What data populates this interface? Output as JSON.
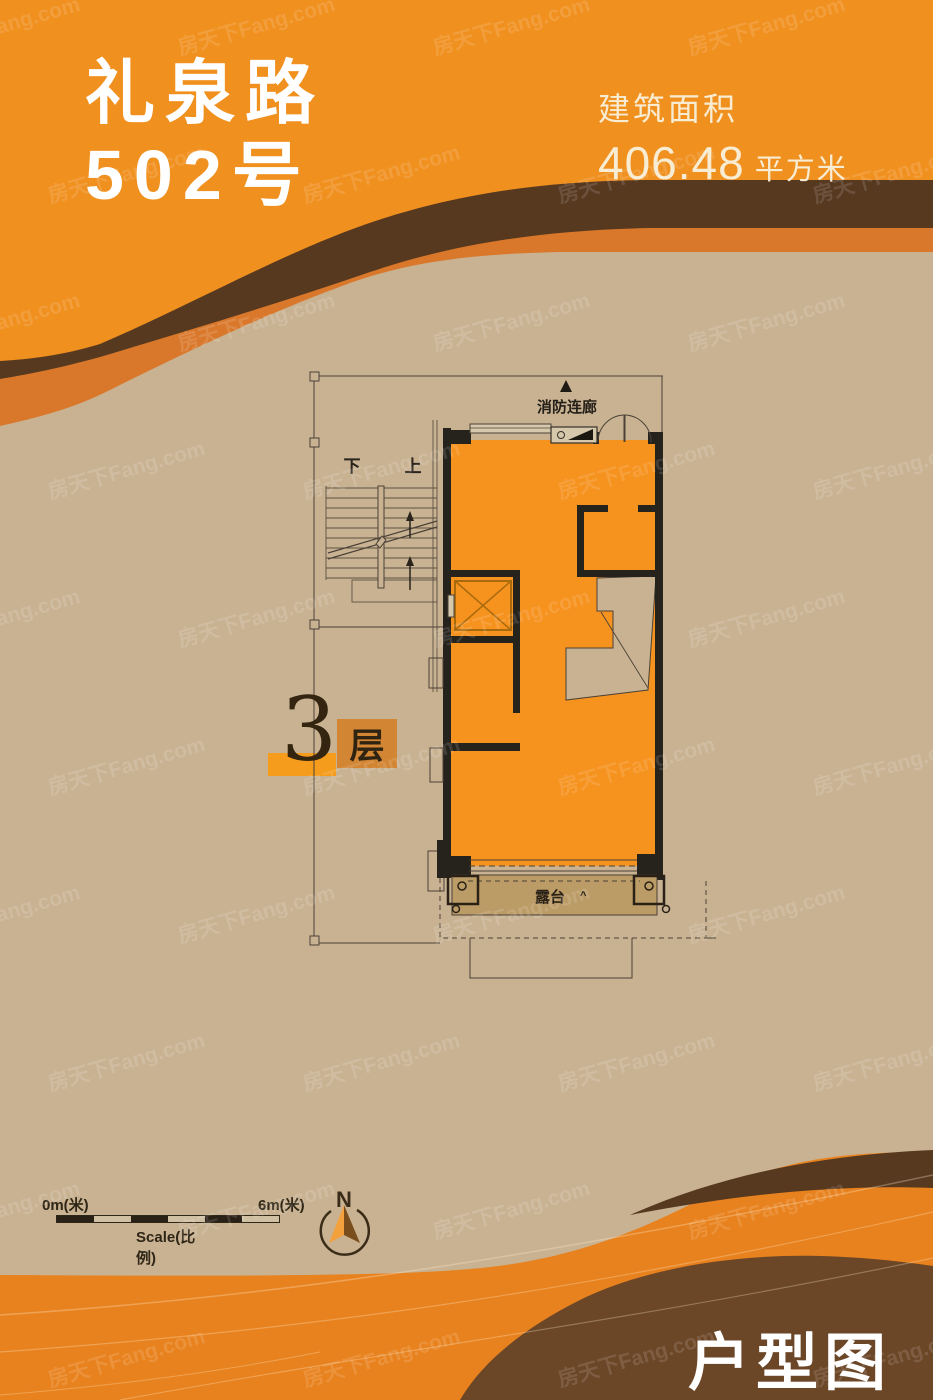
{
  "header": {
    "title_line1": "礼泉路",
    "title_line2": "502号",
    "area_label": "建筑面积",
    "area_value": "406.48",
    "area_unit": "平方米"
  },
  "floor_badge": {
    "number": "3",
    "suffix": "层"
  },
  "plan": {
    "corridor_label": "消防连廊",
    "stairs_down": "下",
    "stairs_up": "上",
    "terrace_label": "露台",
    "terrace_mark": "^"
  },
  "scale_bar": {
    "start": "0m(米)",
    "end": "6m(米)",
    "label": "Scale(比例)"
  },
  "compass": {
    "north": "N"
  },
  "footer": {
    "title": "户型图"
  },
  "watermark": {
    "text": "房天下Fang.com"
  },
  "colors": {
    "brand_orange": "#F0901F",
    "band_brown": "#573920",
    "band_orange": "#D9782B",
    "body_tan": "#C9B292",
    "plan_orange": "#F6921E",
    "wall_dark": "#26231D",
    "line_dark": "#4A4238",
    "terrace_tan": "#BC9C66",
    "floor_badge_bar": "#F59C1C",
    "floor_badge_square": "#D28532",
    "footer_brown": "#6B4627",
    "bottom_band_orange": "#E8821E",
    "bottom_sliver_brown": "#573920",
    "cream_text": "#F8ECD2",
    "text_dark": "#2A2116"
  }
}
